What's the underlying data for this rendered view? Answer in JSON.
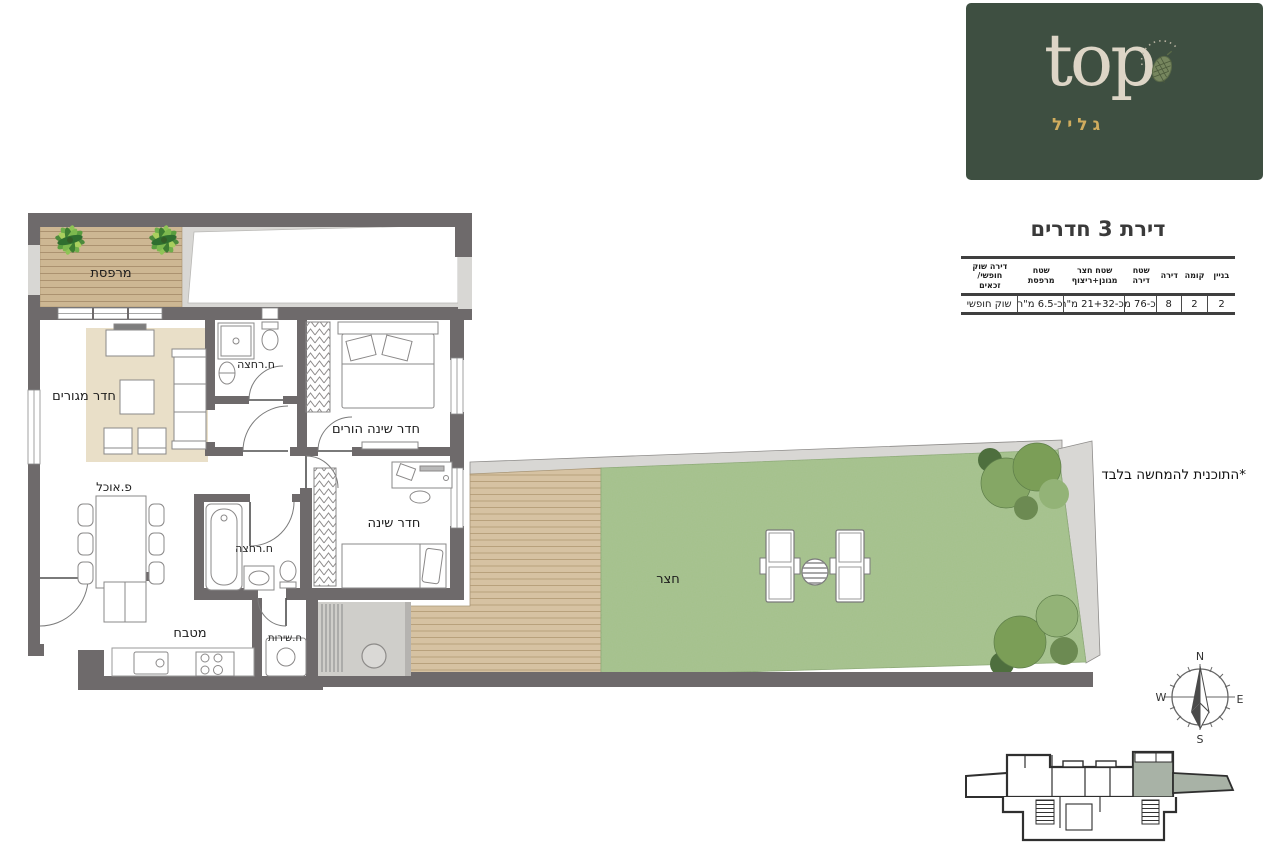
{
  "brand": {
    "name": "top",
    "subtitle": "גליל"
  },
  "page": {
    "title": "דירת 3 חדרים",
    "disclaimer": "*התוכנית להמחשה בלבד"
  },
  "spec_table": {
    "columns": [
      {
        "header": "בניין",
        "value": "2"
      },
      {
        "header": "קומה",
        "value": "2"
      },
      {
        "header": "דירה",
        "value": "8"
      },
      {
        "header": "שטח\nדירה",
        "value": "כ-76 מ\"ר"
      },
      {
        "header": "שטח חצר\nמגונן+ריצוף",
        "value": "כ-21+32 מ\"ר"
      },
      {
        "header": "שטח\nמרפסת",
        "value": "כ-6.5 מ\"ר"
      },
      {
        "header": "דירה שוק\nחופשי/\nזכאים",
        "value": "שוק חופשי"
      }
    ]
  },
  "rooms": {
    "balcony": "מרפסת",
    "living": "חדר מגורים",
    "bath1": "ח.רחצה",
    "parents_bedroom": "חדר שינה הורים",
    "dining": "פ.אוכל",
    "bedroom": "חדר שינה",
    "bath2": "ח.רחצה",
    "kitchen": "מטבח",
    "service": "ח.שירות",
    "yard": "חצר"
  },
  "compass": {
    "n": "N",
    "e": "E",
    "s": "S",
    "w": "W"
  },
  "colors": {
    "wall": "#6e6a6b",
    "light_wall": "#d8d7d4",
    "grass": "#a4c18b",
    "deck": "#d4c09e",
    "rug": "#e9dfc8",
    "logo_bg": "#3e4f41",
    "logo_text": "#ddd5c6",
    "logo_gold": "#d0ac5e",
    "keyplan_highlight": "#a8b2a6"
  }
}
